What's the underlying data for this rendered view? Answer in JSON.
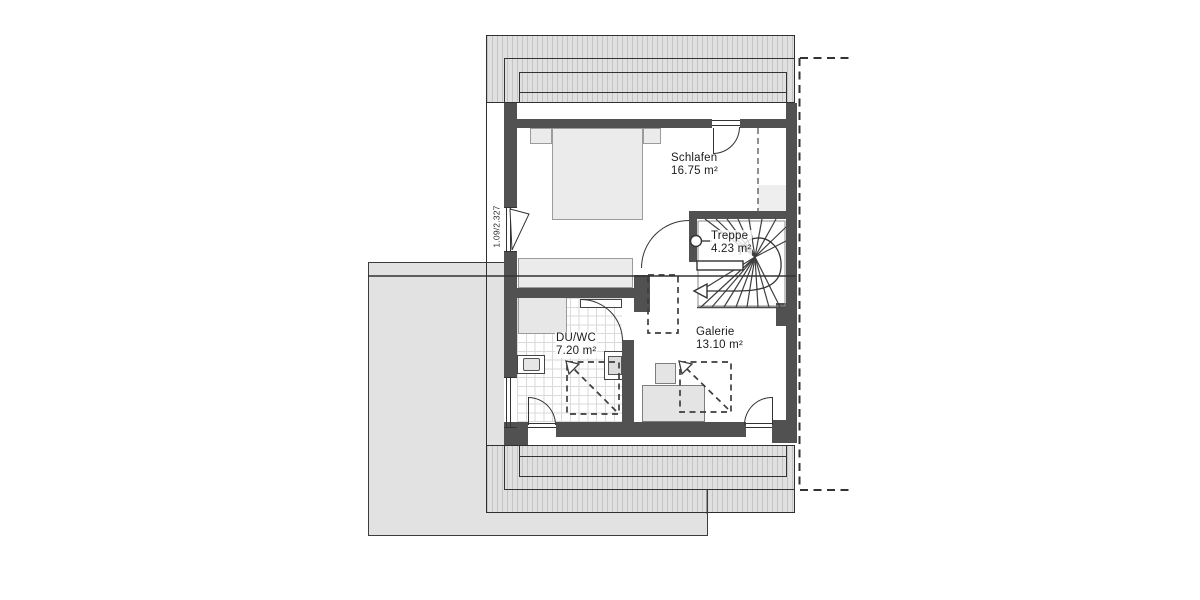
{
  "rooms": {
    "schlafen": {
      "name": "Schlafen",
      "area": "16.75 m²"
    },
    "treppe": {
      "name": "Treppe",
      "area": "4.23 m²"
    },
    "duwc": {
      "name": "DU/WC",
      "area": "7.20 m²"
    },
    "galerie": {
      "name": "Galerie",
      "area": "13.10 m²"
    }
  },
  "annotations": {
    "window_dimension": "1.09/2.327"
  },
  "colors": {
    "wall": "#515151",
    "roof_fill": "#e0e0e0",
    "roof_hatch_line": "#c4c4c4",
    "garage_fill": "#e2e2e2",
    "line": "#333333"
  }
}
